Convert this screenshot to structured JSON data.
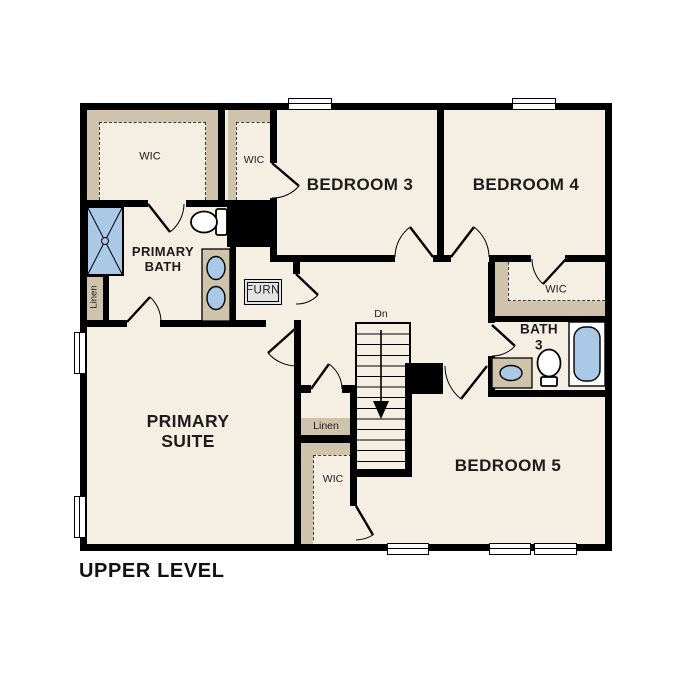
{
  "title": "UPPER LEVEL",
  "colors": {
    "floor": "#f5eee2",
    "shelf": "#cfc3ab",
    "fixture_blue": "#aac9e6",
    "furn_fill": "#e4e4e4",
    "wall": "#000000"
  },
  "rooms": {
    "wic_primary": {
      "label": "WIC"
    },
    "wic_bedroom3": {
      "label": "WIC"
    },
    "bedroom3": {
      "label": "BEDROOM 3"
    },
    "bedroom4": {
      "label": "BEDROOM 4"
    },
    "primary_bath": {
      "line1": "PRIMARY",
      "line2": "BATH"
    },
    "linen_hall": {
      "label": "Linen"
    },
    "furnace": {
      "label": "FURN"
    },
    "wic_bedroom4": {
      "label": "WIC"
    },
    "bath3": {
      "line1": "BATH",
      "line2": "3"
    },
    "primary_suite": {
      "line1": "PRIMARY",
      "line2": "SUITE"
    },
    "linen_center": {
      "label": "Linen"
    },
    "wic_center": {
      "label": "WIC"
    },
    "bedroom5": {
      "label": "BEDROOM 5"
    },
    "stairs": {
      "label": "Dn"
    }
  }
}
